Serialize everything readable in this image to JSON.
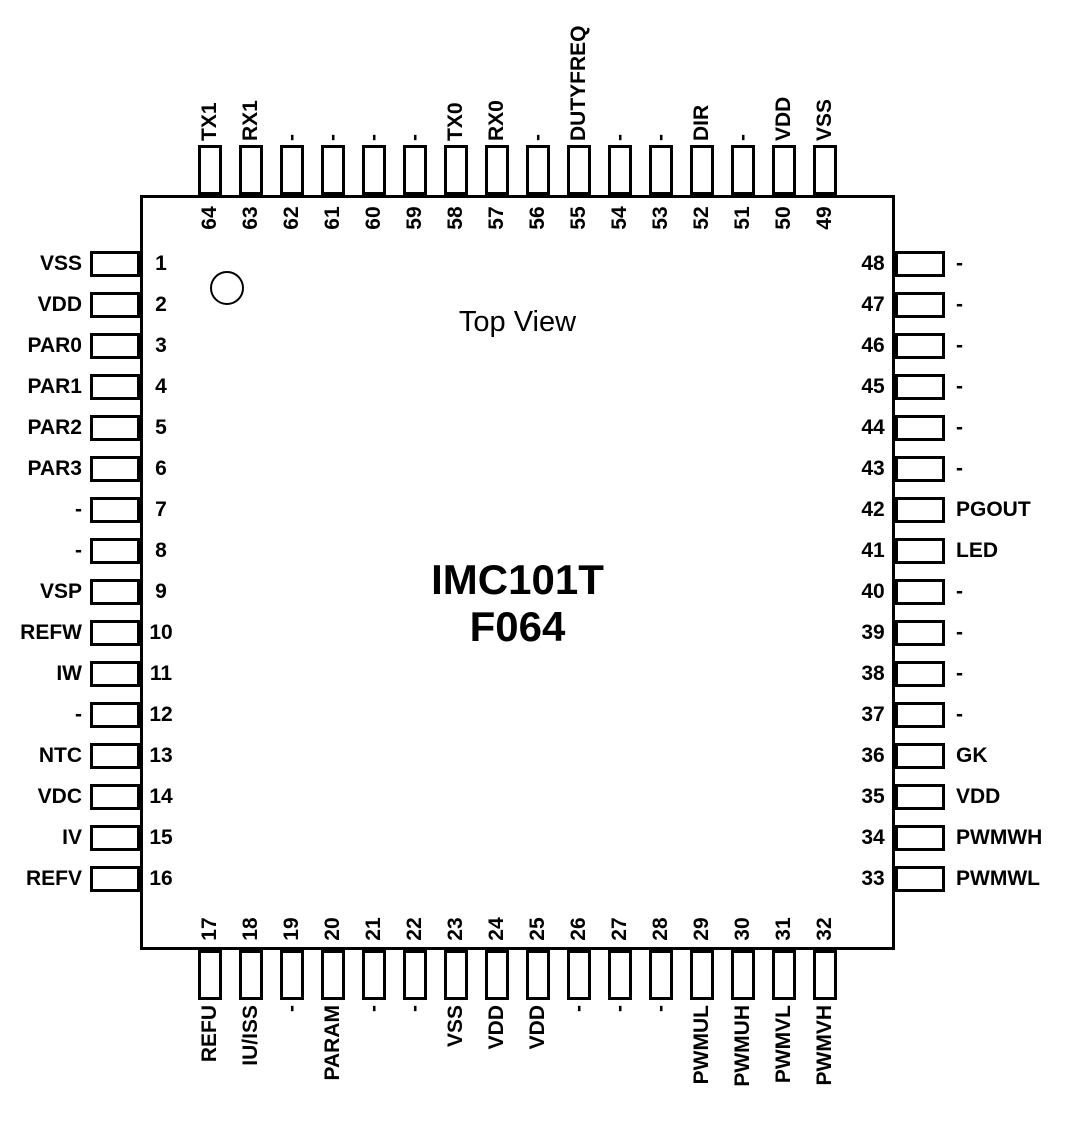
{
  "diagram": {
    "view_label": "Top View",
    "chip_title": "IMC101T",
    "chip_package": "F064"
  },
  "package": {
    "left_pins": [
      {
        "number": 1,
        "label": "VSS"
      },
      {
        "number": 2,
        "label": "VDD"
      },
      {
        "number": 3,
        "label": "PAR0"
      },
      {
        "number": 4,
        "label": "PAR1"
      },
      {
        "number": 5,
        "label": "PAR2"
      },
      {
        "number": 6,
        "label": "PAR3"
      },
      {
        "number": 7,
        "label": "-"
      },
      {
        "number": 8,
        "label": "-"
      },
      {
        "number": 9,
        "label": "VSP"
      },
      {
        "number": 10,
        "label": "REFW"
      },
      {
        "number": 11,
        "label": "IW"
      },
      {
        "number": 12,
        "label": "-"
      },
      {
        "number": 13,
        "label": "NTC"
      },
      {
        "number": 14,
        "label": "VDC"
      },
      {
        "number": 15,
        "label": "IV"
      },
      {
        "number": 16,
        "label": "REFV"
      }
    ],
    "top_pins": [
      {
        "number": 64,
        "label": "TX1"
      },
      {
        "number": 63,
        "label": "RX1"
      },
      {
        "number": 62,
        "label": "-"
      },
      {
        "number": 61,
        "label": "-"
      },
      {
        "number": 60,
        "label": "-"
      },
      {
        "number": 59,
        "label": "-"
      },
      {
        "number": 58,
        "label": "TX0"
      },
      {
        "number": 57,
        "label": "RX0"
      },
      {
        "number": 56,
        "label": "-"
      },
      {
        "number": 55,
        "label": "DUTYFREQ"
      },
      {
        "number": 54,
        "label": "-"
      },
      {
        "number": 53,
        "label": "-"
      },
      {
        "number": 52,
        "label": "DIR"
      },
      {
        "number": 51,
        "label": "-"
      },
      {
        "number": 50,
        "label": "VDD"
      },
      {
        "number": 49,
        "label": "VSS"
      }
    ],
    "right_pins": [
      {
        "number": 48,
        "label": "-"
      },
      {
        "number": 47,
        "label": "-"
      },
      {
        "number": 46,
        "label": "-"
      },
      {
        "number": 45,
        "label": "-"
      },
      {
        "number": 44,
        "label": "-"
      },
      {
        "number": 43,
        "label": "-"
      },
      {
        "number": 42,
        "label": "PGOUT"
      },
      {
        "number": 41,
        "label": "LED"
      },
      {
        "number": 40,
        "label": "-"
      },
      {
        "number": 39,
        "label": "-"
      },
      {
        "number": 38,
        "label": "-"
      },
      {
        "number": 37,
        "label": "-"
      },
      {
        "number": 36,
        "label": "GK"
      },
      {
        "number": 35,
        "label": "VDD"
      },
      {
        "number": 34,
        "label": "PWMWH"
      },
      {
        "number": 33,
        "label": "PWMWL"
      }
    ],
    "bottom_pins": [
      {
        "number": 17,
        "label": "REFU"
      },
      {
        "number": 18,
        "label": "IU/ISS"
      },
      {
        "number": 19,
        "label": "-"
      },
      {
        "number": 20,
        "label": "PARAM"
      },
      {
        "number": 21,
        "label": "-"
      },
      {
        "number": 22,
        "label": "-"
      },
      {
        "number": 23,
        "label": "VSS"
      },
      {
        "number": 24,
        "label": "VDD"
      },
      {
        "number": 25,
        "label": "VDD"
      },
      {
        "number": 26,
        "label": "-"
      },
      {
        "number": 27,
        "label": "-"
      },
      {
        "number": 28,
        "label": "-"
      },
      {
        "number": 29,
        "label": "PWMUL"
      },
      {
        "number": 30,
        "label": "PWMUH"
      },
      {
        "number": 31,
        "label": "PWMVL"
      },
      {
        "number": 32,
        "label": "PWMVH"
      }
    ]
  },
  "colors": {
    "line": "#000000",
    "background": "#ffffff",
    "text": "#000000"
  }
}
